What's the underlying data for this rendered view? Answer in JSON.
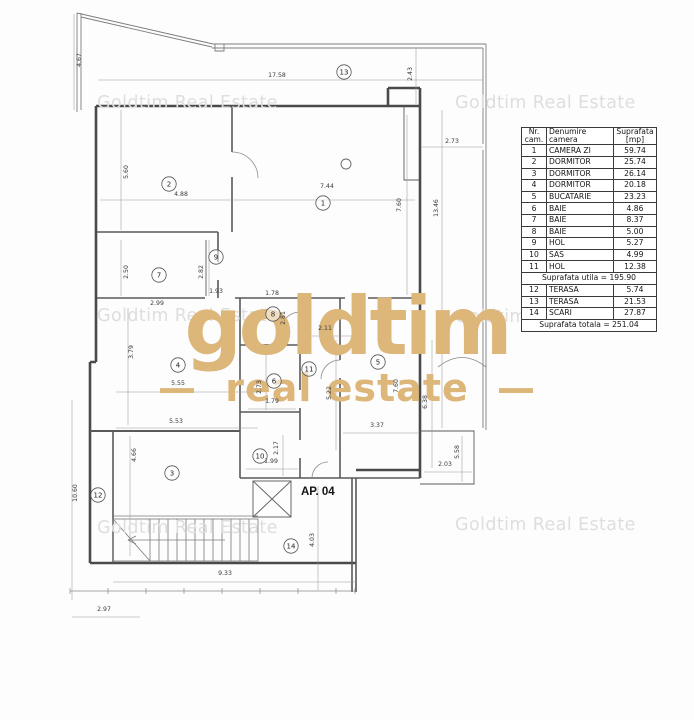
{
  "watermark": {
    "text": "Goldtim Real Estate"
  },
  "logo": {
    "wordmark": "goldtim",
    "tagline": "real estate",
    "dash": "—",
    "color": "#ddb67a"
  },
  "unit_label": "AP. 04",
  "table": {
    "headers": [
      "Nr.\ncam.",
      "Denumire\ncamera",
      "Suprafata\n[mp]"
    ],
    "rooms": [
      {
        "nr": "1",
        "name": "CAMERA ZI",
        "area": "59.74"
      },
      {
        "nr": "2",
        "name": "DORMITOR",
        "area": "25.74"
      },
      {
        "nr": "3",
        "name": "DORMITOR",
        "area": "26.14"
      },
      {
        "nr": "4",
        "name": "DORMITOR",
        "area": "20.18"
      },
      {
        "nr": "5",
        "name": "BUCATARIE",
        "area": "23.23"
      },
      {
        "nr": "6",
        "name": "BAIE",
        "area": "4.86"
      },
      {
        "nr": "7",
        "name": "BAIE",
        "area": "8.37"
      },
      {
        "nr": "8",
        "name": "BAIE",
        "area": "5.00"
      },
      {
        "nr": "9",
        "name": "HOL",
        "area": "5.27"
      },
      {
        "nr": "10",
        "name": "SAS",
        "area": "4.99"
      },
      {
        "nr": "11",
        "name": "HOL",
        "area": "12.38"
      }
    ],
    "subtotal": {
      "label": "Suprafata utila =",
      "value": "195.90"
    },
    "annex_rooms": [
      {
        "nr": "12",
        "name": "TERASA",
        "area": "5.74"
      },
      {
        "nr": "13",
        "name": "TERASA",
        "area": "21.53"
      },
      {
        "nr": "14",
        "name": "SCARI",
        "area": "27.87"
      }
    ],
    "total": {
      "label": "Suprafata totala =",
      "value": "251.04"
    }
  },
  "plan": {
    "room_markers": [
      {
        "n": "1",
        "x": 323,
        "y": 203
      },
      {
        "n": "2",
        "x": 169,
        "y": 184
      },
      {
        "n": "3",
        "x": 172,
        "y": 473
      },
      {
        "n": "4",
        "x": 178,
        "y": 365
      },
      {
        "n": "5",
        "x": 378,
        "y": 362
      },
      {
        "n": "6",
        "x": 274,
        "y": 381
      },
      {
        "n": "7",
        "x": 159,
        "y": 275
      },
      {
        "n": "8",
        "x": 273,
        "y": 314
      },
      {
        "n": "9",
        "x": 216,
        "y": 257
      },
      {
        "n": "10",
        "x": 260,
        "y": 456
      },
      {
        "n": "11",
        "x": 309,
        "y": 369
      },
      {
        "n": "12",
        "x": 98,
        "y": 495
      },
      {
        "n": "13",
        "x": 344,
        "y": 72
      },
      {
        "n": "14",
        "x": 291,
        "y": 546
      }
    ],
    "dimensions": [
      {
        "v": "4.67",
        "x": 81,
        "y": 60,
        "rot": true
      },
      {
        "v": "17.58",
        "x": 277,
        "y": 77,
        "rot": false
      },
      {
        "v": "2.43",
        "x": 412,
        "y": 74,
        "rot": true
      },
      {
        "v": "2.73",
        "x": 452,
        "y": 143,
        "rot": false
      },
      {
        "v": "5.60",
        "x": 128,
        "y": 172,
        "rot": true
      },
      {
        "v": "4.88",
        "x": 181,
        "y": 196,
        "rot": false
      },
      {
        "v": "7.44",
        "x": 327,
        "y": 188,
        "rot": false
      },
      {
        "v": "7.60",
        "x": 401,
        "y": 205,
        "rot": true
      },
      {
        "v": "13.46",
        "x": 438,
        "y": 208,
        "rot": true
      },
      {
        "v": "2.50",
        "x": 128,
        "y": 272,
        "rot": true
      },
      {
        "v": "2.82",
        "x": 203,
        "y": 272,
        "rot": true
      },
      {
        "v": "1.93",
        "x": 216,
        "y": 293,
        "rot": false
      },
      {
        "v": "1.78",
        "x": 272,
        "y": 295,
        "rot": false
      },
      {
        "v": "2.99",
        "x": 157,
        "y": 305,
        "rot": false
      },
      {
        "v": "2.81",
        "x": 285,
        "y": 318,
        "rot": true
      },
      {
        "v": "3.79",
        "x": 133,
        "y": 352,
        "rot": true
      },
      {
        "v": "2.11",
        "x": 325,
        "y": 330,
        "rot": false
      },
      {
        "v": "5.55",
        "x": 178,
        "y": 385,
        "rot": false
      },
      {
        "v": "2.73",
        "x": 261,
        "y": 387,
        "rot": true
      },
      {
        "v": "5.22",
        "x": 331,
        "y": 393,
        "rot": true
      },
      {
        "v": "7.60",
        "x": 398,
        "y": 386,
        "rot": true
      },
      {
        "v": "6.38",
        "x": 427,
        "y": 402,
        "rot": true
      },
      {
        "v": "1.79",
        "x": 272,
        "y": 403,
        "rot": false
      },
      {
        "v": "5.53",
        "x": 176,
        "y": 423,
        "rot": false
      },
      {
        "v": "3.37",
        "x": 377,
        "y": 427,
        "rot": false
      },
      {
        "v": "2.17",
        "x": 278,
        "y": 448,
        "rot": true
      },
      {
        "v": "4.66",
        "x": 136,
        "y": 455,
        "rot": true
      },
      {
        "v": "1.99",
        "x": 271,
        "y": 463,
        "rot": false
      },
      {
        "v": "5.58",
        "x": 459,
        "y": 452,
        "rot": true
      },
      {
        "v": "2.03",
        "x": 445,
        "y": 466,
        "rot": false
      },
      {
        "v": "10.60",
        "x": 77,
        "y": 493,
        "rot": true
      },
      {
        "v": "4.03",
        "x": 314,
        "y": 540,
        "rot": true
      },
      {
        "v": "9.33",
        "x": 225,
        "y": 575,
        "rot": false
      },
      {
        "v": "2.97",
        "x": 104,
        "y": 611,
        "rot": false
      }
    ]
  }
}
